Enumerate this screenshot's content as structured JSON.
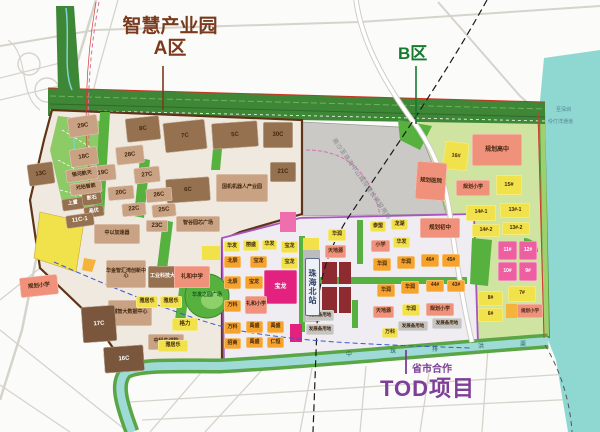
{
  "titles": {
    "area_a_line1": "智慧产业园",
    "area_a_line2": "A区",
    "area_a_color": "#7a3a1d",
    "area_b": "B区",
    "area_b_color": "#157a2e",
    "tod_sub": "省市合作",
    "tod_main": "TOD项目",
    "tod_color": "#7d3f98"
  },
  "labels": {
    "station": "珠海北站",
    "reserve": "南沙至珠海中山城际建设预留用地",
    "river_name": "中珠排洪渠"
  },
  "water_labels": [
    {
      "t": "至深圳",
      "x": 556,
      "y": 106
    },
    {
      "t": "伶仃洋通道",
      "x": 548,
      "y": 118
    }
  ],
  "river_chars": [
    {
      "t": "中",
      "x": 346,
      "y": 349
    },
    {
      "t": "珠",
      "x": 390,
      "y": 346
    },
    {
      "t": "排",
      "x": 432,
      "y": 344
    },
    {
      "t": "洪",
      "x": 478,
      "y": 341
    },
    {
      "t": "渠",
      "x": 520,
      "y": 339
    }
  ],
  "palette": {
    "tan": "#c9a284",
    "brown": "#96714f",
    "darkbrown": "#7a573c",
    "yellow": "#f1e24b",
    "orange": "#f5a32c",
    "salmon": "#f0917c",
    "pink": "#ee5fa2",
    "magenta": "#e3217e",
    "gray": "#c5c4c2",
    "none": "transparent"
  },
  "parcels": [
    {
      "t": "29C",
      "x": 68,
      "y": 116,
      "w": 30,
      "h": 20,
      "c": "tan",
      "rot": -8
    },
    {
      "t": "8C",
      "x": 126,
      "y": 117,
      "w": 34,
      "h": 24,
      "c": "brown",
      "rot": -6
    },
    {
      "t": "7C",
      "x": 164,
      "y": 121,
      "w": 42,
      "h": 30,
      "c": "brown",
      "rot": -6
    },
    {
      "t": "5C",
      "x": 212,
      "y": 122,
      "w": 46,
      "h": 26,
      "c": "brown",
      "rot": -4
    },
    {
      "t": "30C",
      "x": 263,
      "y": 122,
      "w": 30,
      "h": 26,
      "c": "brown"
    },
    {
      "t": "28C",
      "x": 116,
      "y": 146,
      "w": 28,
      "h": 18,
      "c": "tan",
      "rot": -6
    },
    {
      "t": "18C",
      "x": 70,
      "y": 148,
      "w": 28,
      "h": 18,
      "c": "tan",
      "rot": -8
    },
    {
      "t": "13C",
      "x": 28,
      "y": 163,
      "w": 26,
      "h": 22,
      "c": "brown",
      "rot": -8
    },
    {
      "t": "19C",
      "x": 90,
      "y": 165,
      "w": 26,
      "h": 16,
      "c": "tan",
      "rot": -6
    },
    {
      "t": "27C",
      "x": 134,
      "y": 167,
      "w": 26,
      "h": 16,
      "c": "tan",
      "rot": -6
    },
    {
      "t": "21C",
      "x": 270,
      "y": 162,
      "w": 26,
      "h": 20,
      "c": "brown"
    },
    {
      "t": "6C",
      "x": 166,
      "y": 178,
      "w": 44,
      "h": 24,
      "c": "brown",
      "rot": -4
    },
    {
      "t": "国机机器人产业园",
      "x": 216,
      "y": 174,
      "w": 52,
      "h": 28,
      "c": "tan",
      "fs": 5
    },
    {
      "t": "银河航天",
      "x": 66,
      "y": 168,
      "w": 32,
      "h": 13,
      "c": "tan",
      "fs": 5,
      "rot": -8
    },
    {
      "t": "光珀智能",
      "x": 70,
      "y": 182,
      "w": 32,
      "h": 12,
      "c": "tan",
      "fs": 5,
      "rot": -8
    },
    {
      "t": "20C",
      "x": 108,
      "y": 186,
      "w": 26,
      "h": 14,
      "c": "tan",
      "rot": -5
    },
    {
      "t": "26C",
      "x": 146,
      "y": 188,
      "w": 26,
      "h": 14,
      "c": "tan",
      "rot": -5
    },
    {
      "t": "上置",
      "x": 62,
      "y": 198,
      "w": 22,
      "h": 12,
      "c": "brown",
      "fs": 5,
      "rot": -8,
      "tc": "#fff"
    },
    {
      "t": "影石",
      "x": 82,
      "y": 193,
      "w": 20,
      "h": 12,
      "c": "brown",
      "fs": 5,
      "rot": -8,
      "tc": "#fff"
    },
    {
      "t": "晶优",
      "x": 84,
      "y": 206,
      "w": 20,
      "h": 11,
      "c": "brown",
      "fs": 5,
      "rot": -8,
      "tc": "#fff"
    },
    {
      "t": "11C-1",
      "x": 66,
      "y": 214,
      "w": 28,
      "h": 13,
      "c": "brown",
      "rot": -8,
      "tc": "#fff"
    },
    {
      "t": "22C",
      "x": 122,
      "y": 203,
      "w": 24,
      "h": 13,
      "c": "tan",
      "rot": -5
    },
    {
      "t": "25C",
      "x": 152,
      "y": 204,
      "w": 24,
      "h": 13,
      "c": "tan",
      "rot": -5
    },
    {
      "t": "中以加速器",
      "x": 94,
      "y": 224,
      "w": 46,
      "h": 20,
      "c": "tan",
      "fs": 5
    },
    {
      "t": "23C",
      "x": 146,
      "y": 220,
      "w": 22,
      "h": 12,
      "c": "tan"
    },
    {
      "t": "智谷园芯广场",
      "x": 176,
      "y": 216,
      "w": 44,
      "h": 16,
      "c": "tan",
      "fs": 5
    },
    {
      "t": "华金智汇湾创新中心",
      "x": 106,
      "y": 260,
      "w": 40,
      "h": 28,
      "c": "tan",
      "fs": 5
    },
    {
      "t": "工业科技大厦",
      "x": 148,
      "y": 266,
      "w": 34,
      "h": 22,
      "c": "brown",
      "fs": 5,
      "tc": "#fff"
    },
    {
      "t": "礼和中学",
      "x": 174,
      "y": 266,
      "w": 36,
      "h": 22,
      "c": "salmon",
      "fs": 5.5
    },
    {
      "t": "规划小学",
      "x": 20,
      "y": 276,
      "w": 38,
      "h": 20,
      "c": "salmon",
      "fs": 5.5,
      "rot": -6
    },
    {
      "t": "诚智大数据中心",
      "x": 108,
      "y": 300,
      "w": 44,
      "h": 26,
      "c": "tan",
      "fs": 5
    },
    {
      "t": "17C",
      "x": 82,
      "y": 306,
      "w": 34,
      "h": 36,
      "c": "darkbrown",
      "tc": "#fff",
      "rot": -4
    },
    {
      "t": "16C",
      "x": 104,
      "y": 346,
      "w": 40,
      "h": 26,
      "c": "darkbrown",
      "tc": "#fff",
      "rot": -4
    },
    {
      "t": "中科先进院",
      "x": 148,
      "y": 334,
      "w": 36,
      "h": 16,
      "c": "tan",
      "fs": 5
    },
    {
      "t": "雅居乐",
      "x": 136,
      "y": 296,
      "w": 22,
      "h": 12,
      "c": "yellow",
      "fs": 5
    },
    {
      "t": "雅居乐",
      "x": 160,
      "y": 296,
      "w": 22,
      "h": 12,
      "c": "yellow",
      "fs": 5
    },
    {
      "t": "格力",
      "x": 172,
      "y": 318,
      "w": 26,
      "h": 13,
      "c": "yellow",
      "fs": 5.5
    },
    {
      "t": "雅居乐",
      "x": 158,
      "y": 340,
      "w": 30,
      "h": 12,
      "c": "yellow",
      "fs": 5
    },
    {
      "t": "华发",
      "x": 224,
      "y": 241,
      "w": 16,
      "h": 11,
      "c": "yellow",
      "fs": 5
    },
    {
      "t": "丽盛",
      "x": 243,
      "y": 240,
      "w": 16,
      "h": 11,
      "c": "yellow",
      "fs": 5
    },
    {
      "t": "华发",
      "x": 262,
      "y": 240,
      "w": 15,
      "h": 10,
      "c": "yellow",
      "fs": 5
    },
    {
      "t": "宝龙",
      "x": 281,
      "y": 241,
      "w": 17,
      "h": 12,
      "c": "yellow",
      "fs": 5
    },
    {
      "t": "北辰",
      "x": 224,
      "y": 256,
      "w": 17,
      "h": 12,
      "c": "orange",
      "fs": 5
    },
    {
      "t": "宝龙",
      "x": 250,
      "y": 256,
      "w": 17,
      "h": 12,
      "c": "orange",
      "fs": 5
    },
    {
      "t": "宝龙",
      "x": 281,
      "y": 257,
      "w": 17,
      "h": 12,
      "c": "yellow",
      "fs": 5
    },
    {
      "t": "北辰",
      "x": 224,
      "y": 276,
      "w": 17,
      "h": 13,
      "c": "orange",
      "fs": 5
    },
    {
      "t": "宝龙",
      "x": 245,
      "y": 276,
      "w": 18,
      "h": 13,
      "c": "orange",
      "fs": 5
    },
    {
      "t": "宝龙",
      "x": 264,
      "y": 270,
      "w": 33,
      "h": 34,
      "c": "magenta",
      "tc": "#ffffff",
      "fs": 6
    },
    {
      "t": "万科",
      "x": 224,
      "y": 300,
      "w": 17,
      "h": 12,
      "c": "orange",
      "fs": 5
    },
    {
      "t": "礼和小学",
      "x": 245,
      "y": 296,
      "w": 22,
      "h": 18,
      "c": "salmon",
      "fs": 5
    },
    {
      "t": "万科",
      "x": 224,
      "y": 322,
      "w": 17,
      "h": 12,
      "c": "orange",
      "fs": 5
    },
    {
      "t": "禹盛",
      "x": 246,
      "y": 321,
      "w": 17,
      "h": 12,
      "c": "orange",
      "fs": 5
    },
    {
      "t": "禹盛",
      "x": 267,
      "y": 321,
      "w": 17,
      "h": 12,
      "c": "orange",
      "fs": 5
    },
    {
      "t": "招商",
      "x": 224,
      "y": 338,
      "w": 17,
      "h": 11,
      "c": "orange",
      "fs": 5
    },
    {
      "t": "禹盛",
      "x": 246,
      "y": 337,
      "w": 17,
      "h": 11,
      "c": "orange",
      "fs": 5
    },
    {
      "t": "仁恒",
      "x": 267,
      "y": 337,
      "w": 17,
      "h": 11,
      "c": "orange",
      "fs": 5
    },
    {
      "t": "发展备用地",
      "x": 306,
      "y": 310,
      "w": 28,
      "h": 11,
      "c": "gray",
      "fs": 4.5
    },
    {
      "t": "发展备用地",
      "x": 306,
      "y": 324,
      "w": 28,
      "h": 11,
      "c": "gray",
      "fs": 4.5
    },
    {
      "t": "发展备用地",
      "x": 398,
      "y": 321,
      "w": 30,
      "h": 10,
      "c": "gray",
      "fs": 4.5
    },
    {
      "t": "发展备用地",
      "x": 432,
      "y": 318,
      "w": 30,
      "h": 11,
      "c": "gray",
      "fs": 4.5
    },
    {
      "t": "万科",
      "x": 382,
      "y": 328,
      "w": 16,
      "h": 10,
      "c": "yellow",
      "fs": 5
    },
    {
      "t": "华润",
      "x": 328,
      "y": 229,
      "w": 18,
      "h": 12,
      "c": "yellow",
      "fs": 5
    },
    {
      "t": "泰盟",
      "x": 370,
      "y": 221,
      "w": 16,
      "h": 11,
      "c": "yellow",
      "fs": 5
    },
    {
      "t": "龙湖",
      "x": 391,
      "y": 219,
      "w": 17,
      "h": 11,
      "c": "yellow",
      "fs": 5
    },
    {
      "t": "规划初中",
      "x": 420,
      "y": 218,
      "w": 40,
      "h": 20,
      "c": "salmon",
      "fs": 5.5
    },
    {
      "t": "天地源",
      "x": 325,
      "y": 245,
      "w": 21,
      "h": 13,
      "c": "salmon",
      "fs": 5
    },
    {
      "t": "小学",
      "x": 371,
      "y": 240,
      "w": 19,
      "h": 12,
      "c": "salmon",
      "fs": 5
    },
    {
      "t": "华发",
      "x": 393,
      "y": 237,
      "w": 17,
      "h": 11,
      "c": "yellow",
      "fs": 5
    },
    {
      "t": "华润",
      "x": 373,
      "y": 258,
      "w": 18,
      "h": 13,
      "c": "orange",
      "fs": 5
    },
    {
      "t": "华润",
      "x": 397,
      "y": 256,
      "w": 18,
      "h": 13,
      "c": "orange",
      "fs": 5
    },
    {
      "t": "46#",
      "x": 421,
      "y": 254,
      "w": 18,
      "h": 13,
      "c": "orange",
      "fs": 5
    },
    {
      "t": "45#",
      "x": 442,
      "y": 254,
      "w": 18,
      "h": 13,
      "c": "orange",
      "fs": 5
    },
    {
      "t": "华润",
      "x": 377,
      "y": 284,
      "w": 18,
      "h": 13,
      "c": "orange",
      "fs": 5
    },
    {
      "t": "华润",
      "x": 401,
      "y": 281,
      "w": 18,
      "h": 13,
      "c": "orange",
      "fs": 5
    },
    {
      "t": "44#",
      "x": 426,
      "y": 280,
      "w": 18,
      "h": 12,
      "c": "orange",
      "fs": 5
    },
    {
      "t": "43#",
      "x": 447,
      "y": 280,
      "w": 18,
      "h": 12,
      "c": "orange",
      "fs": 5
    },
    {
      "t": "天地源",
      "x": 373,
      "y": 306,
      "w": 21,
      "h": 12,
      "c": "salmon",
      "fs": 5
    },
    {
      "t": "华润",
      "x": 402,
      "y": 304,
      "w": 18,
      "h": 12,
      "c": "yellow",
      "fs": 5
    },
    {
      "t": "规划小学",
      "x": 426,
      "y": 303,
      "w": 28,
      "h": 13,
      "c": "salmon",
      "fs": 5
    },
    {
      "t": "16#",
      "x": 444,
      "y": 142,
      "w": 24,
      "h": 28,
      "c": "yellow",
      "fs": 5.5,
      "rot": 6
    },
    {
      "t": "规划高中",
      "x": 472,
      "y": 134,
      "w": 50,
      "h": 32,
      "c": "salmon",
      "fs": 6
    },
    {
      "t": "规划医院",
      "x": 416,
      "y": 162,
      "w": 30,
      "h": 38,
      "c": "salmon",
      "fs": 5.5,
      "rot": 4
    },
    {
      "t": "规划小学",
      "x": 456,
      "y": 180,
      "w": 34,
      "h": 16,
      "c": "salmon",
      "fs": 5
    },
    {
      "t": "15#",
      "x": 496,
      "y": 175,
      "w": 26,
      "h": 20,
      "c": "yellow",
      "fs": 5.5
    },
    {
      "t": "14#-1",
      "x": 466,
      "y": 205,
      "w": 30,
      "h": 16,
      "c": "yellow",
      "fs": 5
    },
    {
      "t": "13#-1",
      "x": 500,
      "y": 203,
      "w": 30,
      "h": 15,
      "c": "yellow",
      "fs": 5
    },
    {
      "t": "14#-2",
      "x": 472,
      "y": 224,
      "w": 28,
      "h": 13,
      "c": "yellow",
      "fs": 5
    },
    {
      "t": "13#-2",
      "x": 502,
      "y": 222,
      "w": 28,
      "h": 13,
      "c": "yellow",
      "fs": 5
    },
    {
      "t": "11#",
      "x": 498,
      "y": 241,
      "w": 19,
      "h": 19,
      "c": "pink",
      "tc": "#fff",
      "fs": 5
    },
    {
      "t": "12#",
      "x": 519,
      "y": 241,
      "w": 18,
      "h": 19,
      "c": "pink",
      "tc": "#fff",
      "fs": 5
    },
    {
      "t": "10#",
      "x": 498,
      "y": 262,
      "w": 19,
      "h": 19,
      "c": "pink",
      "tc": "#fff",
      "fs": 5
    },
    {
      "t": "9#",
      "x": 519,
      "y": 262,
      "w": 18,
      "h": 19,
      "c": "pink",
      "tc": "#fff",
      "fs": 5
    },
    {
      "t": "7#",
      "x": 508,
      "y": 286,
      "w": 28,
      "h": 16,
      "c": "yellow",
      "fs": 5
    },
    {
      "t": "8#",
      "x": 478,
      "y": 291,
      "w": 25,
      "h": 15,
      "c": "yellow",
      "fs": 5
    },
    {
      "t": "6#",
      "x": 478,
      "y": 308,
      "w": 25,
      "h": 14,
      "c": "yellow",
      "fs": 5
    },
    {
      "t": "规划小学",
      "x": 517,
      "y": 304,
      "w": 26,
      "h": 14,
      "c": "salmon",
      "fs": 4.5
    },
    {
      "t": "华发之园广场",
      "x": 188,
      "y": 284,
      "w": 38,
      "h": 24,
      "c": "none",
      "fs": 5,
      "tc": "#14591f"
    }
  ]
}
